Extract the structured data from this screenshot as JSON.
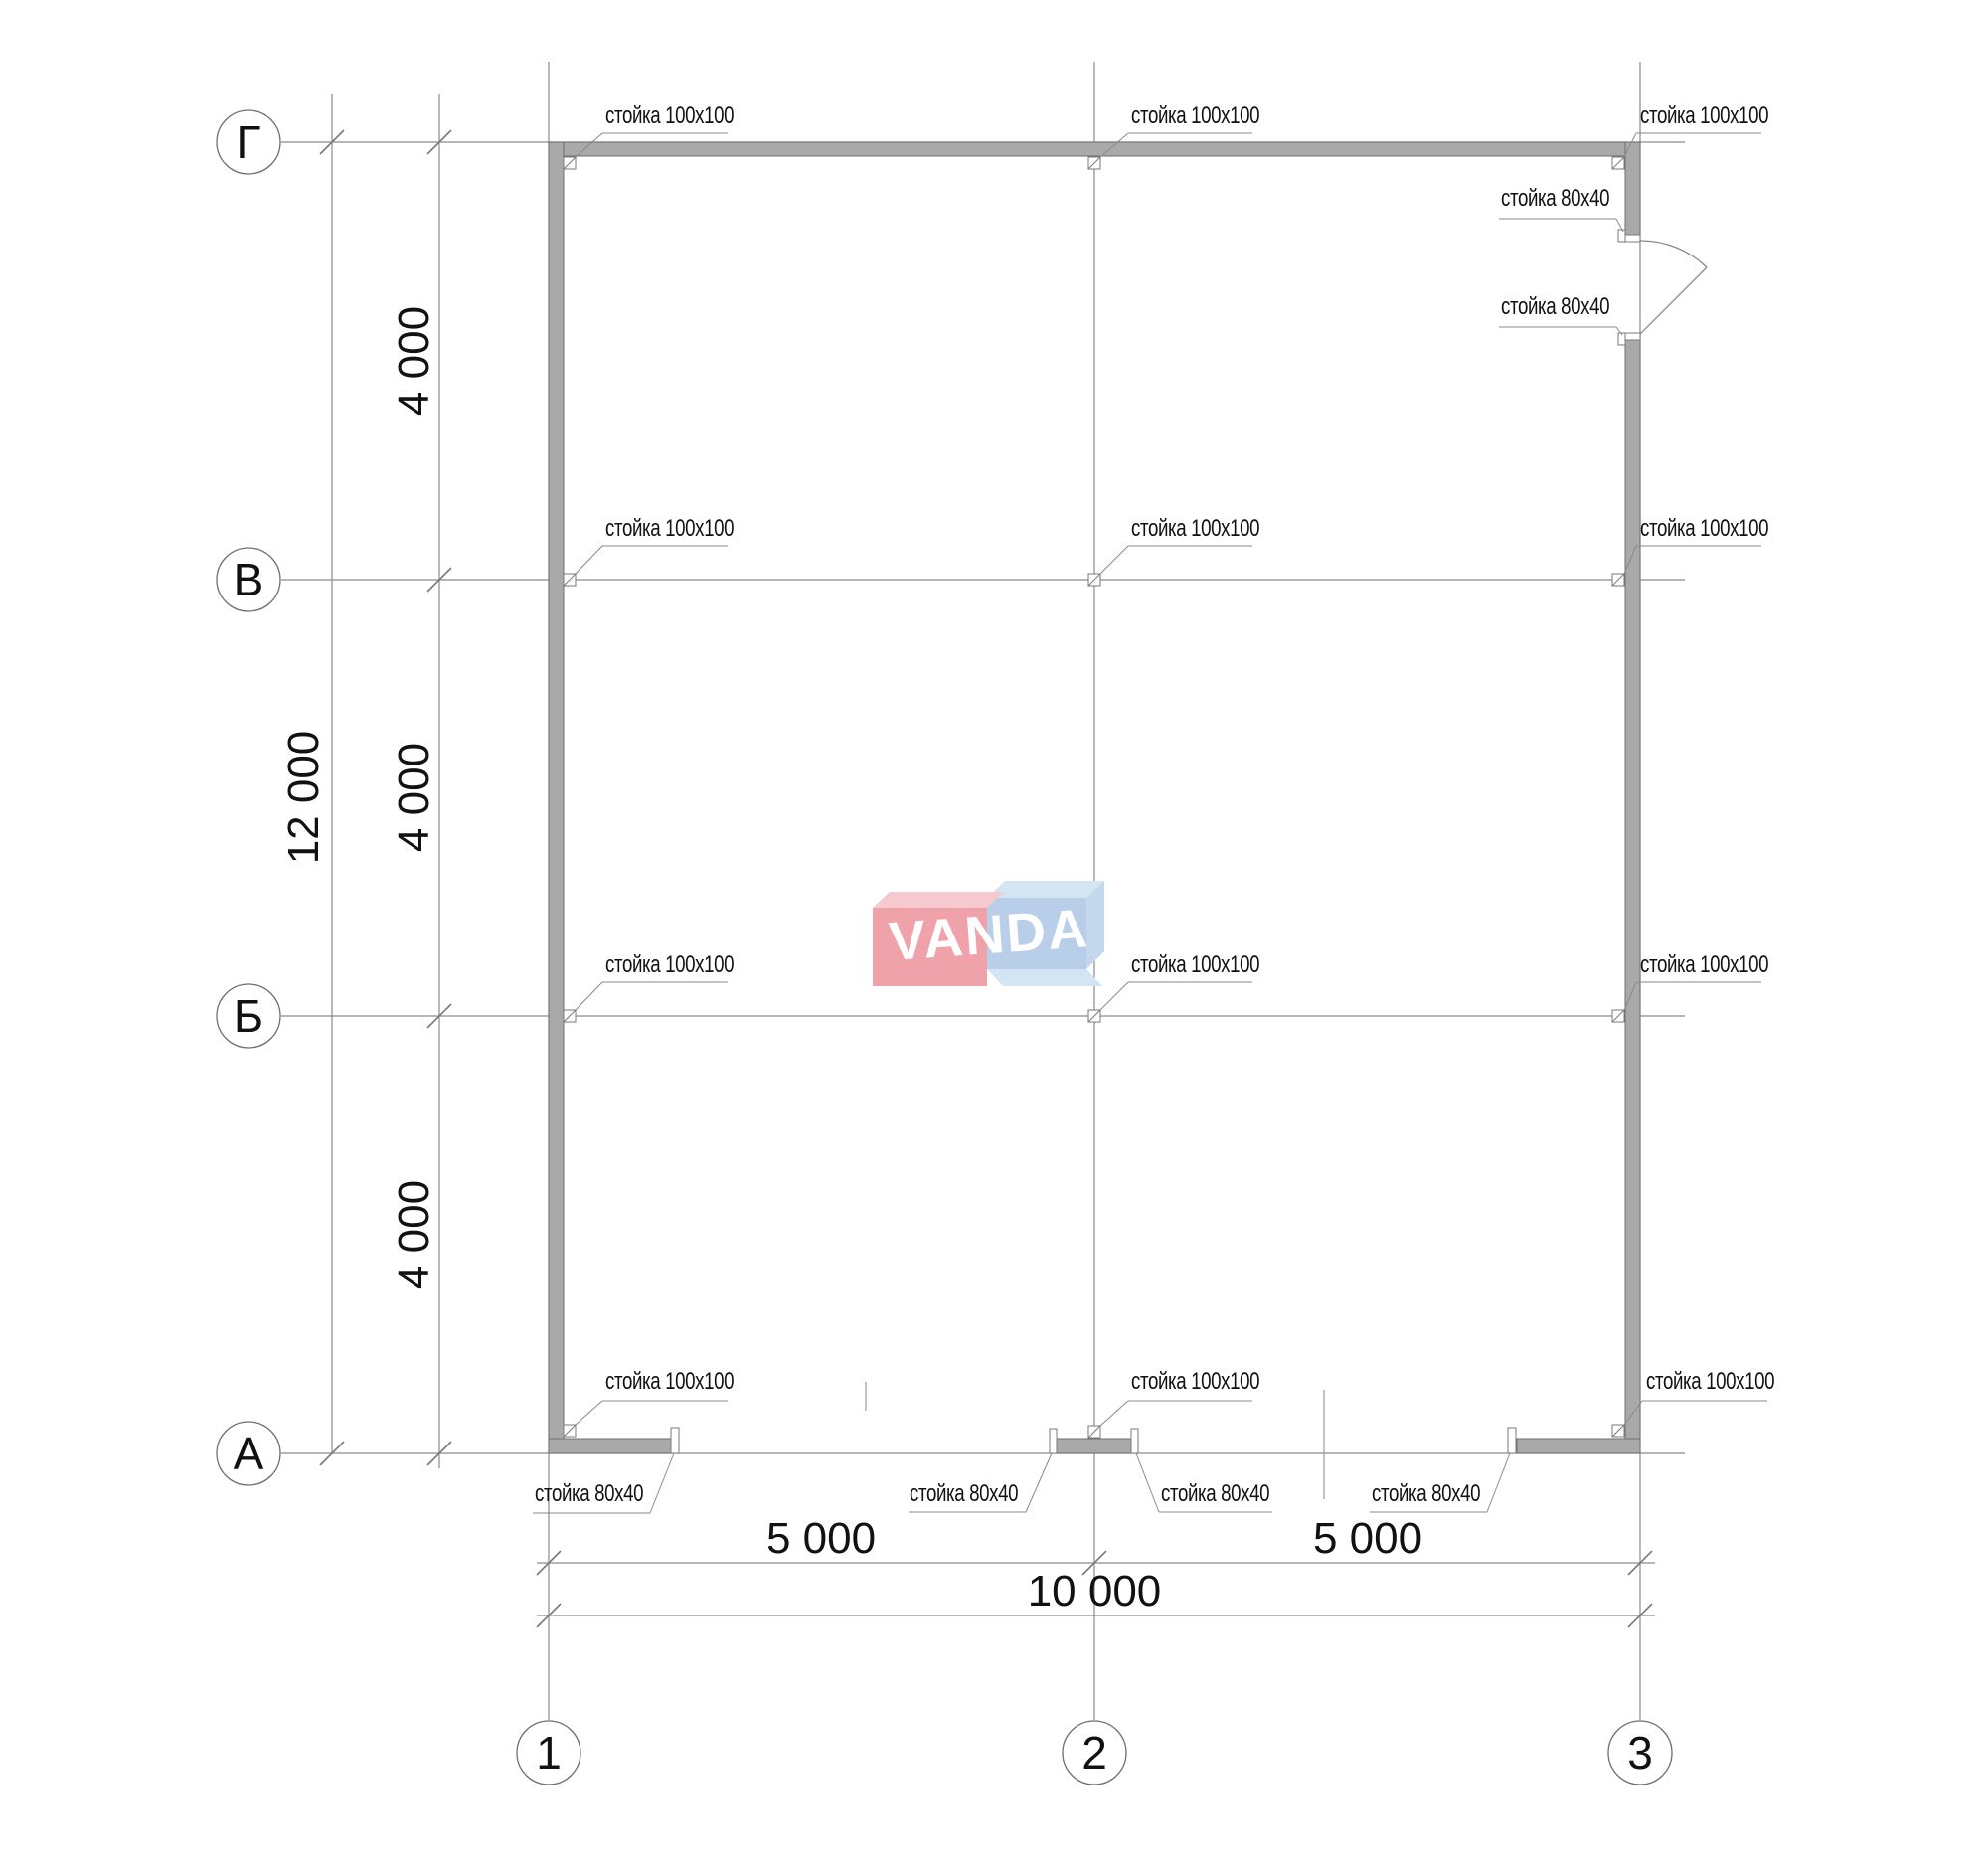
{
  "plan": {
    "axis_rows": [
      "Г",
      "В",
      "Б",
      "А"
    ],
    "axis_cols": [
      "1",
      "2",
      "3"
    ],
    "dimensions": {
      "row_span": "4 000",
      "row_total": "12 000",
      "col_span": "5 000",
      "col_total": "10 000"
    },
    "labels": {
      "post_100": "стойка 100x100",
      "post_80": "стойка 80x40"
    },
    "logo": {
      "text": "VANDA"
    },
    "colors": {
      "wall_fill": "#a9a9a9",
      "wall_edge": "#6f6f6f",
      "line": "#8a8a8a",
      "logo_red": "#f0a2ab",
      "logo_red_top": "#f6c9cf",
      "logo_blue": "#b9cfe9",
      "logo_blue_light": "#d3e4f3",
      "logo_text": "#ffffff"
    }
  }
}
